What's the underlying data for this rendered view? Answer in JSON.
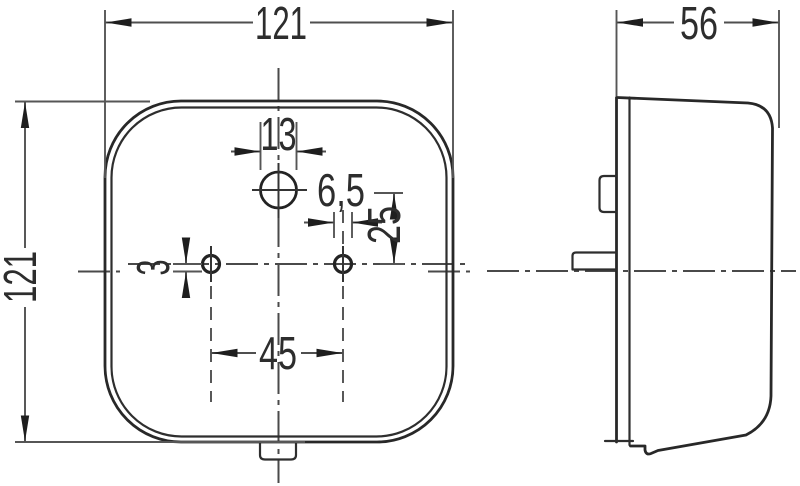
{
  "drawing": {
    "type": "technical-dimension-drawing",
    "views": {
      "front": {
        "name": "front view (rounded square lamp face)"
      },
      "side": {
        "name": "side profile view"
      }
    },
    "colors": {
      "background": "#ffffff",
      "outline": "#282828",
      "dimension_lines": "#4f4f4f",
      "text": "#2d2d2d"
    },
    "dimensions": {
      "front_width": "121",
      "front_height": "121",
      "side_depth": "56",
      "top_hole_diameter": "13",
      "mount_hole_diameter": "6,5",
      "hole_line_to_top_hole": "25",
      "hole_line_offset": "3",
      "mount_hole_spacing": "45"
    }
  }
}
